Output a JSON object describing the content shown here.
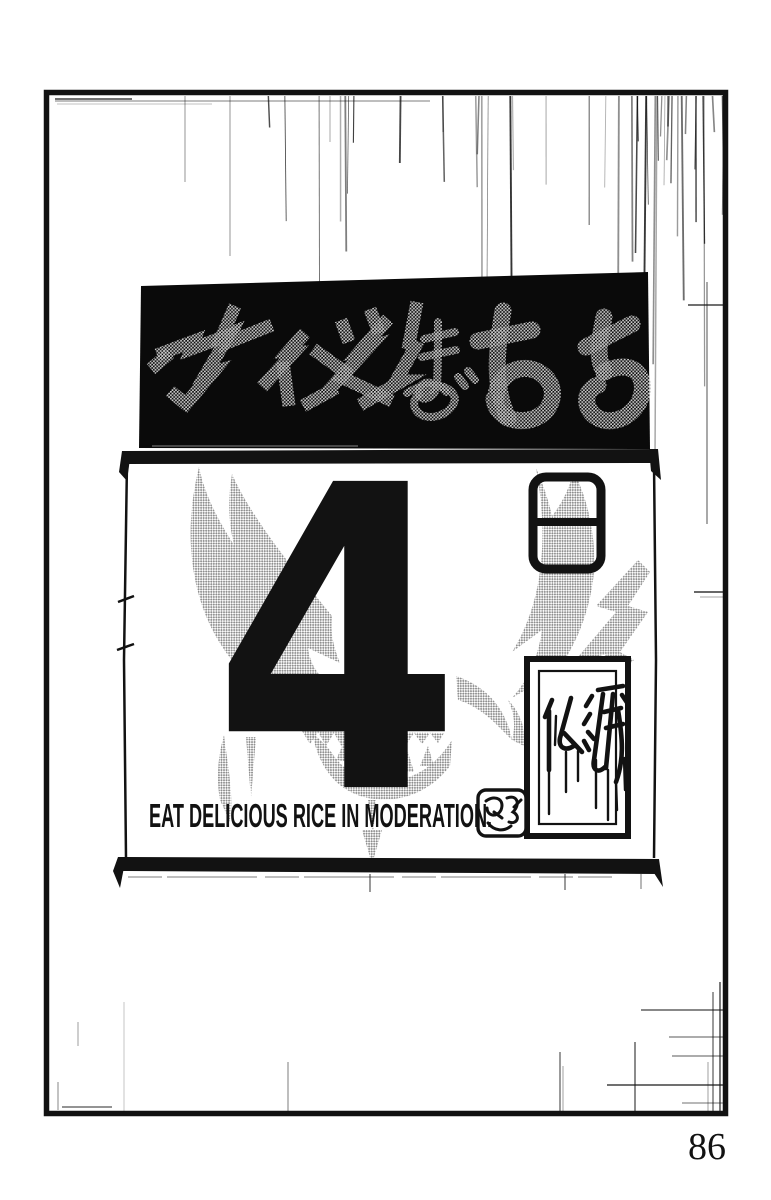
{
  "colors": {
    "ink": "#121212",
    "paper": "#ffffff",
    "tone_gray": "#8e8e8e",
    "banner_black": "#0a0a0a",
    "banner_text_gray": "#c9c9c9"
  },
  "banner": {
    "text": "カイメツまであと"
  },
  "calendar": {
    "day_number": "4",
    "day_kanji": "日",
    "rokuyo_label": "仏滅",
    "caption": "EAT DELICIOUS RICE IN MODERATION.",
    "stamp_icon": "hanko-seal-stamp"
  },
  "page": {
    "number": "86"
  }
}
